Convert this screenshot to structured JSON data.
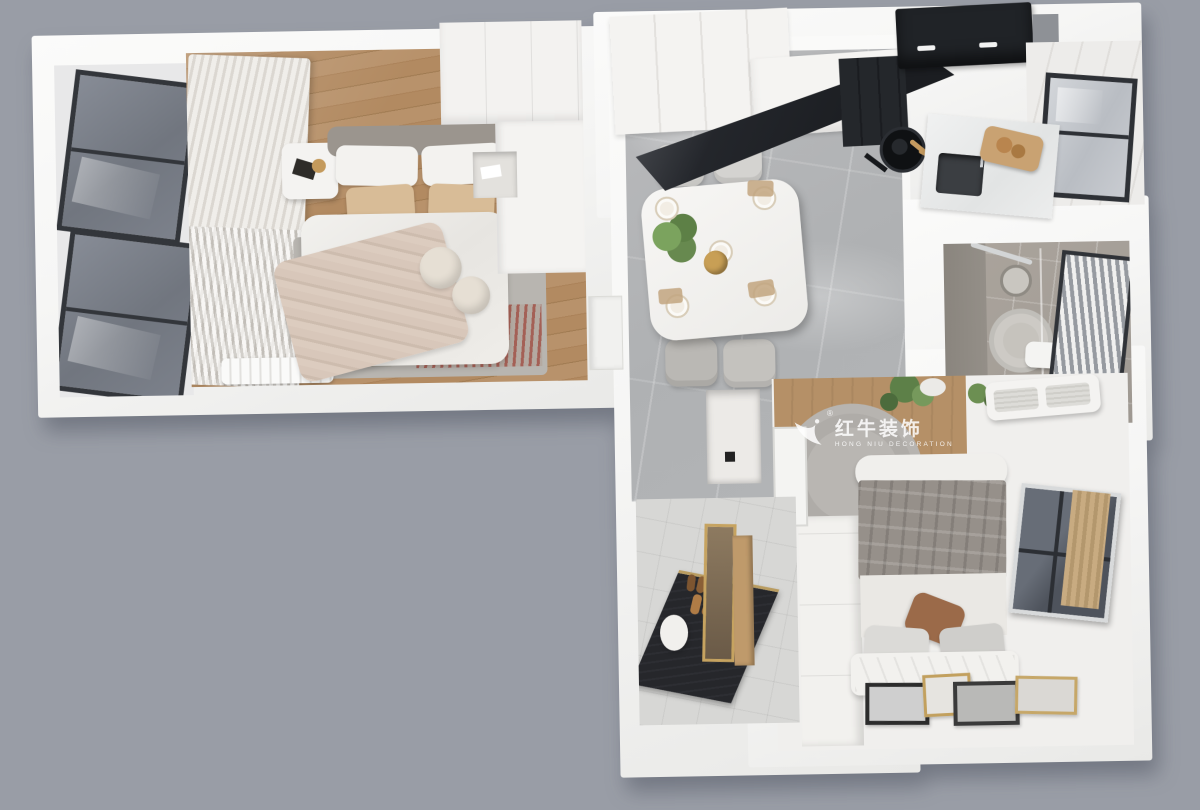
{
  "watermark": {
    "logo_icon": "bull-swoosh-logo",
    "registered": "®",
    "brand_cn": "红牛装饰",
    "brand_en": "HONG NIU DECORATION"
  },
  "palette": {
    "bg": "#999da6",
    "wall": "#f6f6f5",
    "wall_shade": "#e9e9e7",
    "wood_floor": "#b28a61",
    "wood_dark": "#a07b52",
    "marble_floor": "#afb1b3",
    "tile_bath": "#a59f98",
    "entry_tile": "#d7d7d5",
    "glass_dark": "#71767f",
    "frame_black": "#33363b",
    "kitchen_black": "#1b1d21",
    "beige_pillow": "#d8bc97",
    "throw_beige": "#d8c7ba",
    "plaid_gray": "#96908a",
    "rug_gray": "#b8b5b0",
    "rug_red": "#a2574c",
    "plant_green": "#67894f",
    "brown_pillow": "#9b6a49",
    "gold": "#c2a05e",
    "curtain_light": "#f0eeea",
    "curtain_shade": "#dbd7d1"
  }
}
